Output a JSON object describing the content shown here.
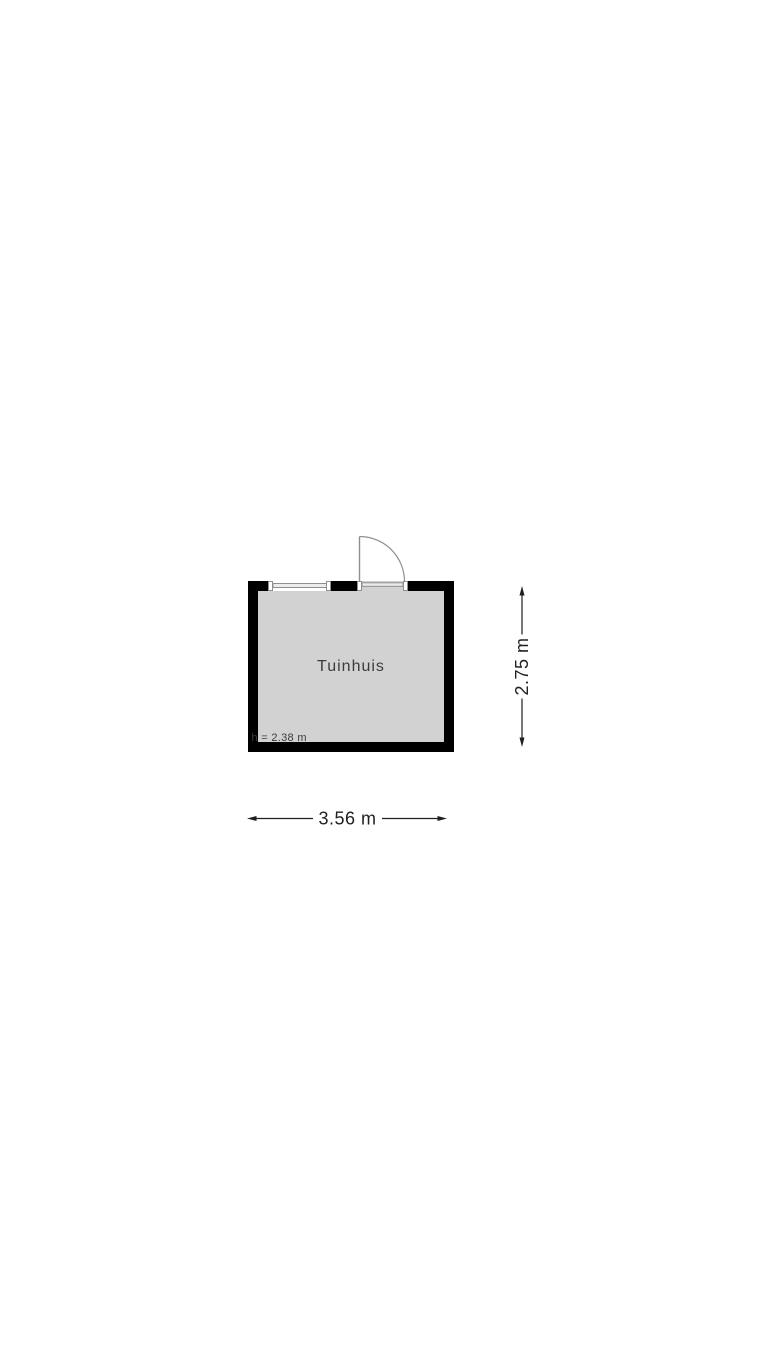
{
  "floorplan": {
    "room": {
      "name": "Tuinhuis",
      "ceiling_height_label": "h = 2.38 m"
    },
    "dimensions": {
      "width_label": "3.56 m",
      "depth_label": "2.75 m"
    },
    "features": [
      {
        "name": "door-swing",
        "wall": "top"
      },
      {
        "name": "window",
        "wall": "top"
      }
    ],
    "colors": {
      "wall": "#000000",
      "floor": "#d2d2d2",
      "fixture_line": "#8f8f8f",
      "label_text": "#3c3c3c",
      "dimension_text": "#1f1f1f",
      "background": "#ffffff"
    }
  }
}
